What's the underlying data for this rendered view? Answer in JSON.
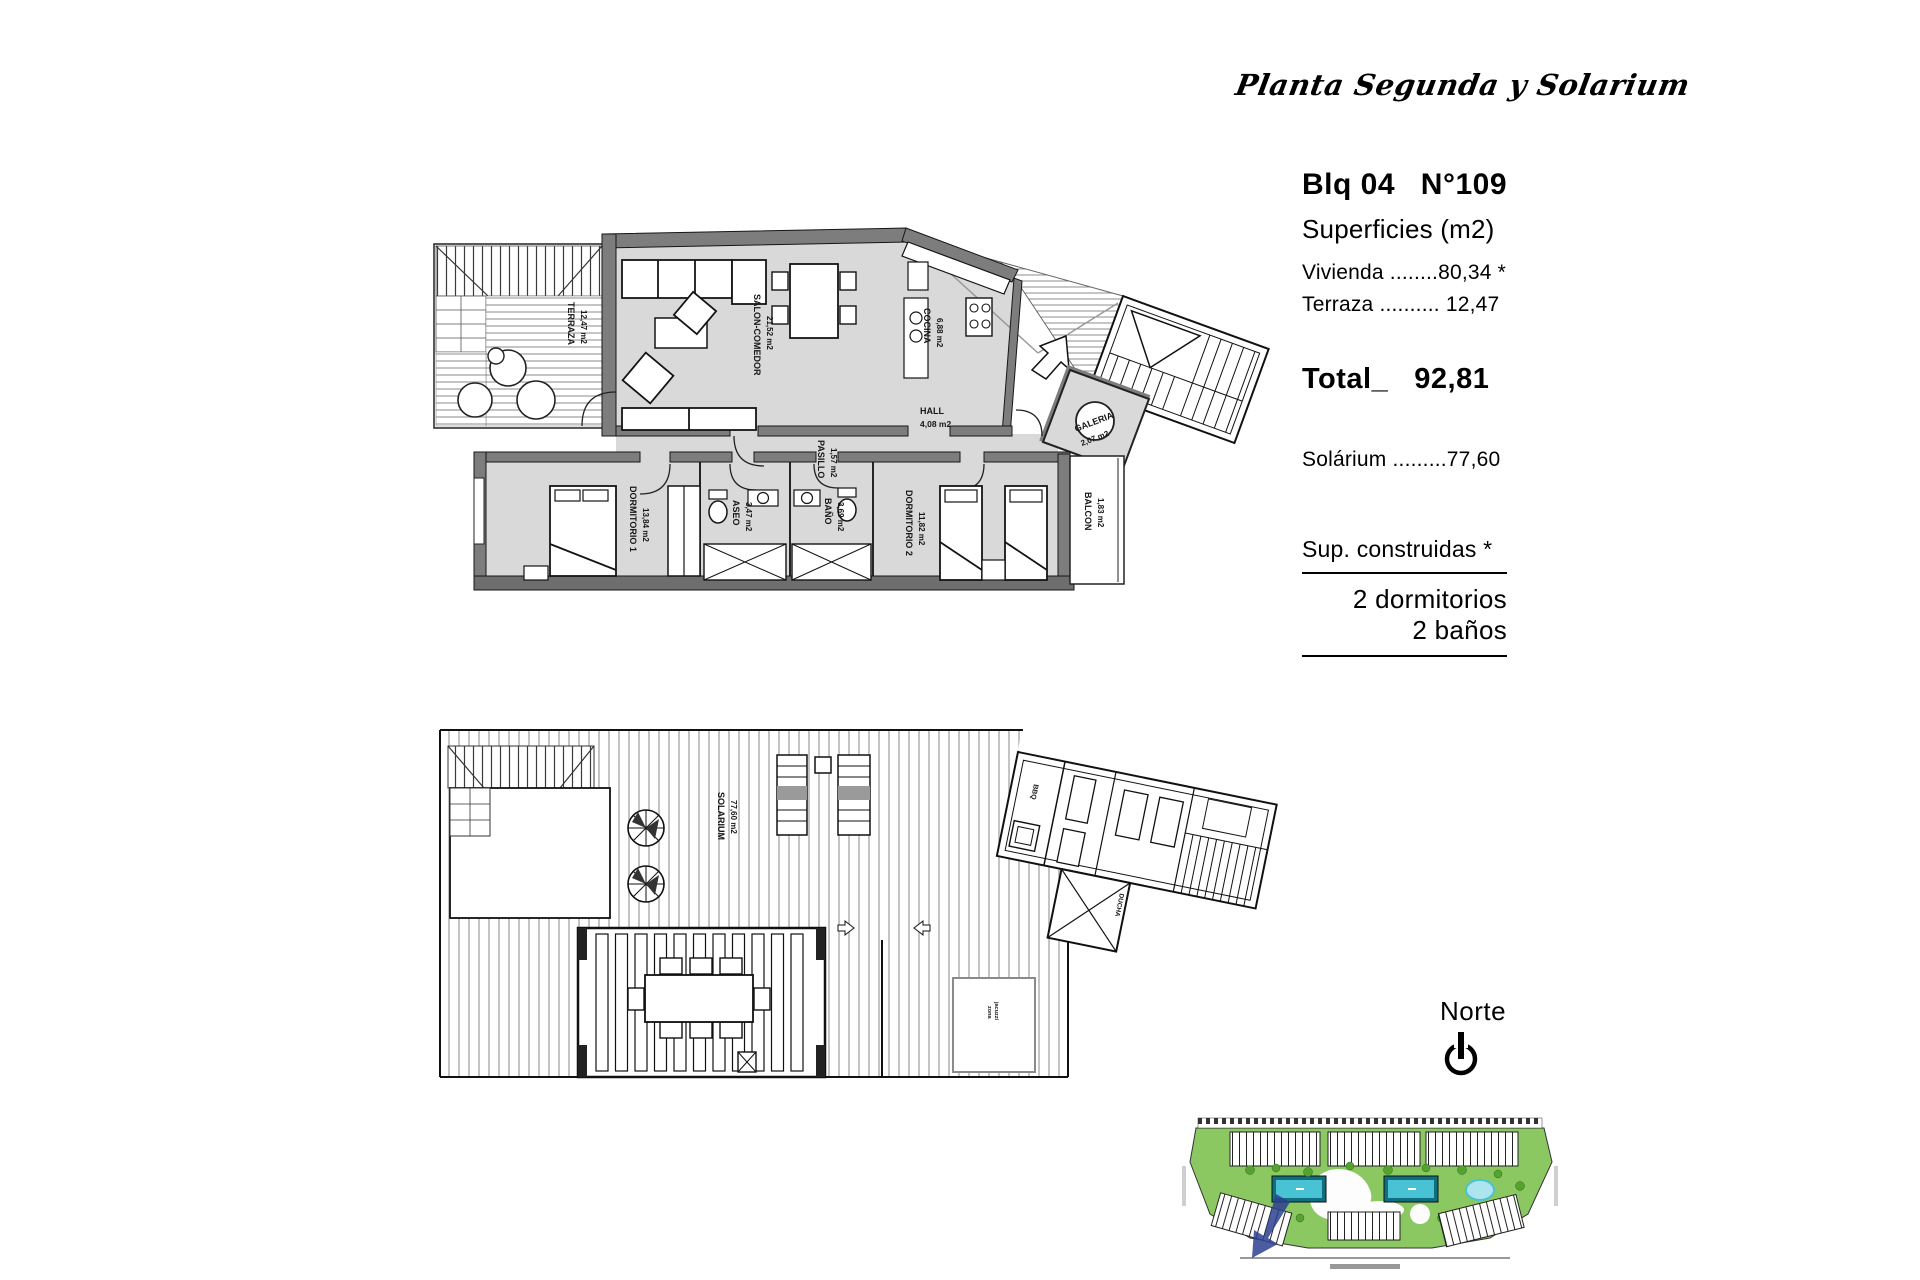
{
  "page_title": "Planta Segunda y Solarium",
  "info_panel": {
    "block_label": "Blq 04",
    "unit_label": "N°109",
    "surfaces_heading": "Superficies (m2)",
    "vivienda_row": "Vivienda ........80,34 *",
    "terraza_row": "Terraza .......... 12,47",
    "total_label": "Total_",
    "total_value": "92,81",
    "solarium_row": "Solárium .........77,60",
    "construidas_note": "Sup. construidas *",
    "bedrooms_line": "2 dormitorios",
    "bathrooms_line": "2 baños"
  },
  "north": {
    "label": "Norte"
  },
  "upper_plan": {
    "rooms": {
      "terraza": {
        "name": "TERRAZA",
        "area": "12,47 m2"
      },
      "salon": {
        "name": "SALON-COMEDOR",
        "area": "21,52 m2"
      },
      "cocina": {
        "name": "COCINA",
        "area": "6,88 m2"
      },
      "hall": {
        "name": "HALL",
        "area": "4,08 m2"
      },
      "galeria": {
        "name": "GALERIA",
        "area": "2,07 m2"
      },
      "pasillo": {
        "name": "PASILLO",
        "area": "1,57 m2"
      },
      "dormitorio1": {
        "name": "DORMITORIO 1",
        "area": "13,84 m2"
      },
      "aseo": {
        "name": "ASEO",
        "area": "3,47 m2"
      },
      "bano": {
        "name": "BAÑO",
        "area": "3,69 m2"
      },
      "dormitorio2": {
        "name": "DORMITORIO 2",
        "area": "11,82 m2"
      },
      "balcon": {
        "name": "BALCON",
        "area": "1,83 m2"
      }
    }
  },
  "lower_plan": {
    "rooms": {
      "solarium": {
        "name": "SOLARIUM",
        "area": "77,60 m2"
      },
      "bbq": {
        "name": "BBQ"
      },
      "ducha": {
        "name": "DUCHA"
      },
      "jacuzzi": {
        "line1": "zona",
        "line2": "jacuzzi"
      }
    }
  },
  "colors": {
    "wall_gray": "#7d7d7d",
    "floor_gray": "#d9d9d9",
    "site_green": "#8cc862",
    "pool_blue": "#49c2d4",
    "marker_blue": "#2b3f8f"
  }
}
